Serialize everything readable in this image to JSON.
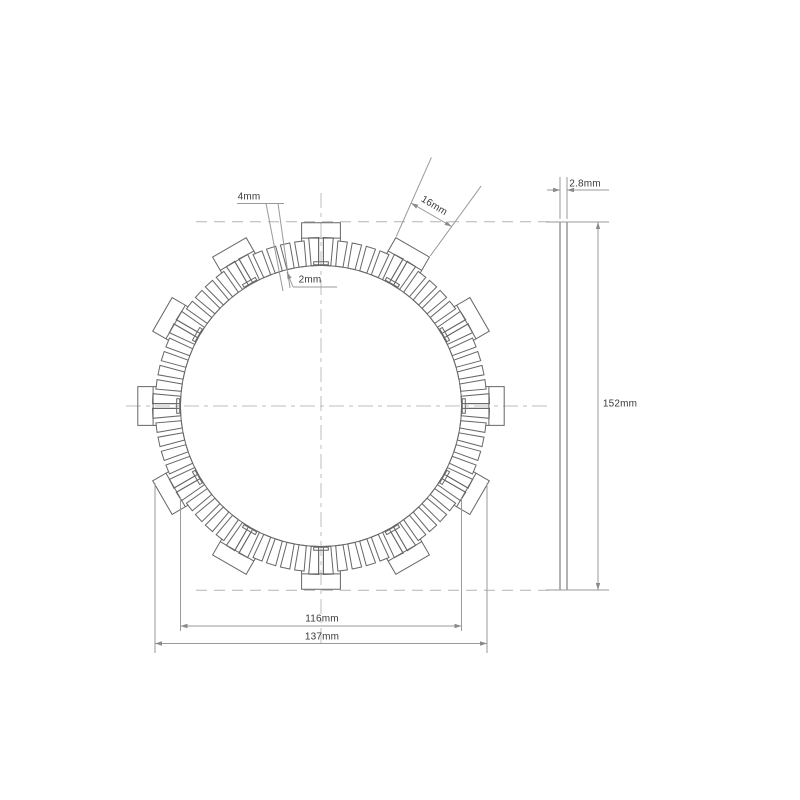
{
  "page": {
    "background": "#ffffff",
    "line_color": "#666666",
    "dim_color": "#9a9a9a",
    "centerline_color": "#bcbcbc",
    "text_color": "#3a3a3a"
  },
  "labels": {
    "pad_width": "4mm",
    "groove_width": "2mm",
    "tab_width": "16mm",
    "thickness": "2.8mm",
    "tab_outer_diameter": "152mm",
    "inner_diameter": "116mm",
    "outer_diameter": "137mm"
  },
  "drawing": {
    "cx": 321,
    "cy": 406,
    "r_inner": 140.5,
    "r_outer": 166,
    "r_step": 169,
    "r_tab": 184.2,
    "tab_count": 12,
    "segment_count": 72,
    "groove_half_px": 2.42,
    "tab_half_px": 19.4,
    "slot_r": 144.5,
    "tbar_r": 141.5,
    "tbar_half_px": 7.3,
    "side_view": {
      "x": 560,
      "width": 7,
      "y_top": 222,
      "y_bottom": 590,
      "dim_x": 598
    }
  }
}
